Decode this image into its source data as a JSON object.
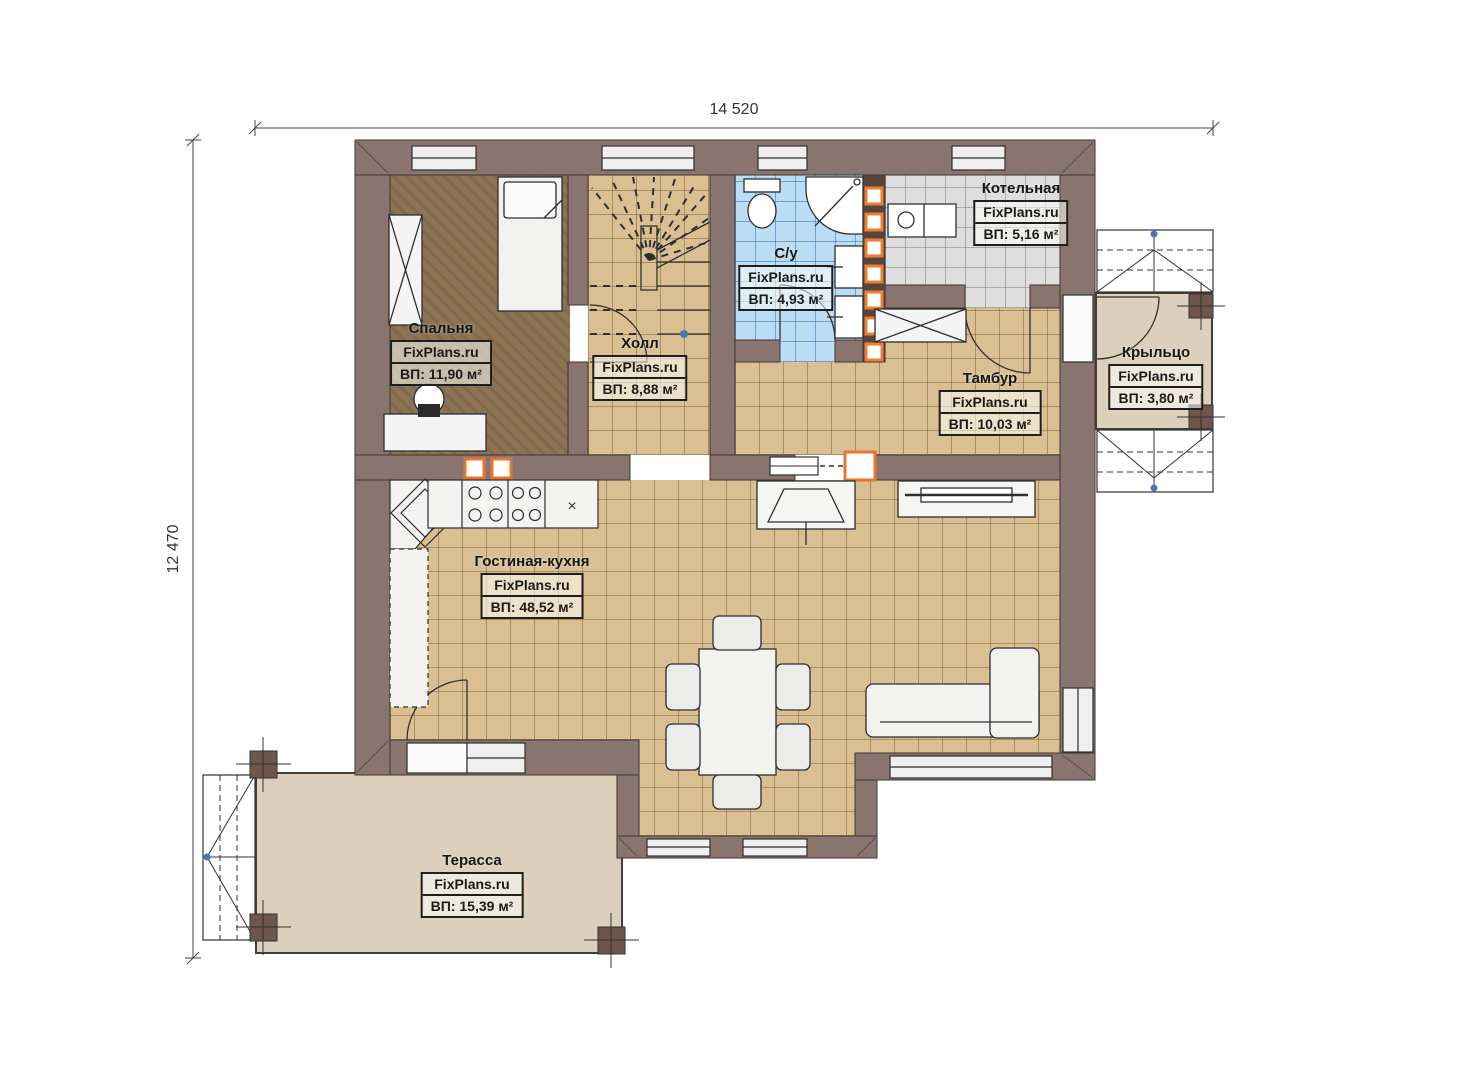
{
  "dimensions": {
    "top": "14 520",
    "left": "12 470"
  },
  "watermark": "FixPlans.ru",
  "furniture_marks": {
    "fridge": "×"
  },
  "rooms": [
    {
      "id": "bedroom",
      "name": "Спальня",
      "area": "ВП: 11,90 м²"
    },
    {
      "id": "hall",
      "name": "Холл",
      "area": "ВП: 8,88 м²"
    },
    {
      "id": "bathroom",
      "name": "С/у",
      "area": "ВП: 4,93 м²"
    },
    {
      "id": "boiler-room",
      "name": "Котельная",
      "area": "ВП: 5,16 м²"
    },
    {
      "id": "vestibule",
      "name": "Тамбур",
      "area": "ВП: 10,03 м²"
    },
    {
      "id": "porch",
      "name": "Крыльцо",
      "area": "ВП: 3,80 м²"
    },
    {
      "id": "living-kitchen",
      "name": "Гостиная-кухня",
      "area": "ВП: 48,52 м²"
    },
    {
      "id": "terrace",
      "name": "Терасса",
      "area": "ВП: 15,39 м²"
    }
  ],
  "palette": {
    "wall": "#8a7470",
    "tile_tan": "#d9bf92",
    "tile_blue": "#badcf4",
    "tile_gray": "#dedede",
    "floor_bedroom": "#8b7354",
    "deck_beige": "#dccfbc",
    "accent_orange": "#e8762d"
  }
}
